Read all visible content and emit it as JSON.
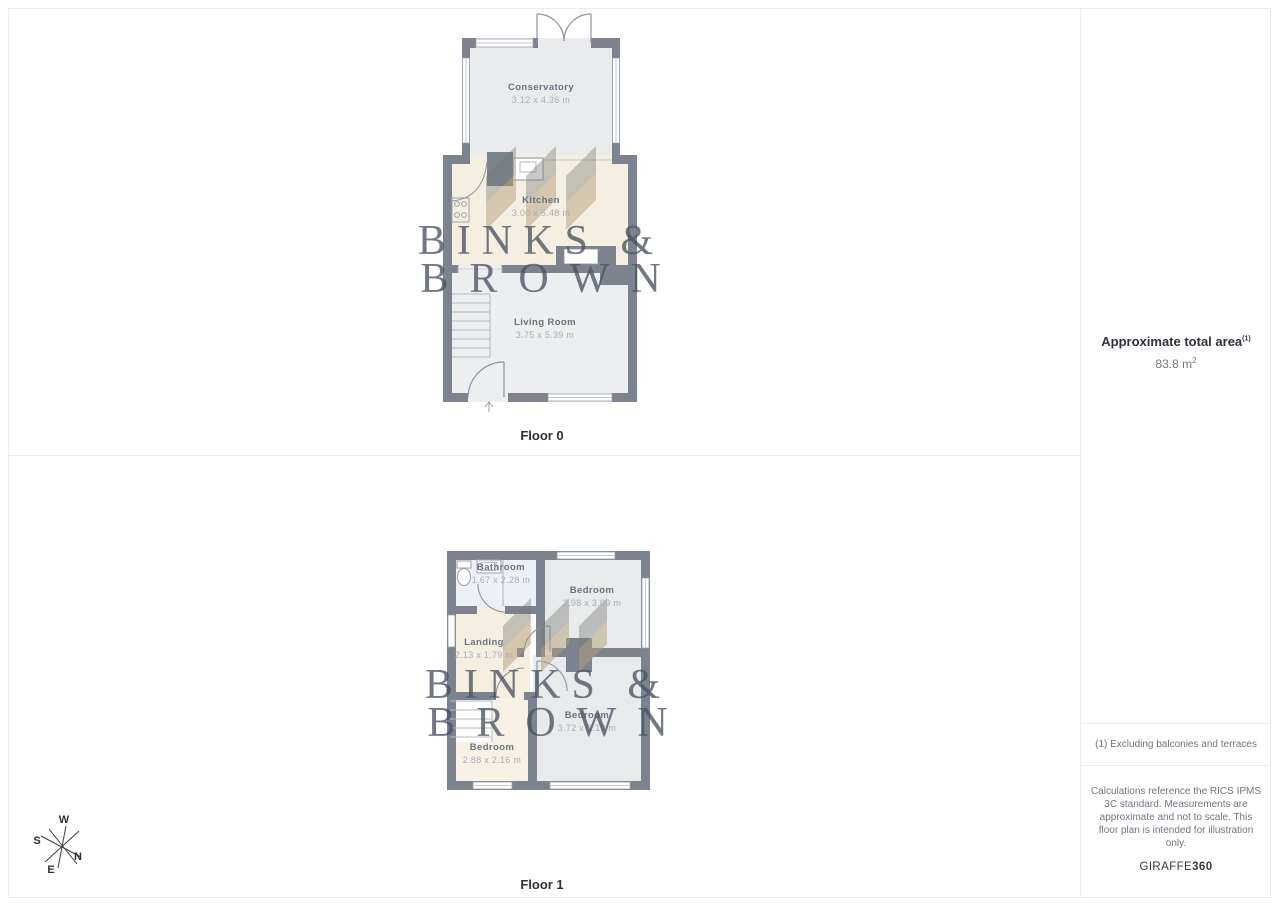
{
  "floor0": {
    "label": "Floor 0",
    "rooms": [
      {
        "name": "Conservatory",
        "dims": "3.12 x 4.36 m"
      },
      {
        "name": "Kitchen",
        "dims": "3.00 x 5.48 m"
      },
      {
        "name": "Living Room",
        "dims": "3.75 x 5.39 m"
      }
    ]
  },
  "floor1": {
    "label": "Floor 1",
    "rooms": [
      {
        "name": "Bathroom",
        "dims": "1.67 x 2.28 m"
      },
      {
        "name": "Bedroom",
        "dims": "2.98 x 3.09 m"
      },
      {
        "name": "Landing",
        "dims": "2.13 x 1.79 m"
      },
      {
        "name": "Bedroom",
        "dims": "2.88 x 2.16 m"
      },
      {
        "name": "Bedroom",
        "dims": "3.72 x 3.19 m"
      }
    ]
  },
  "watermark": {
    "line1": "BINKS &",
    "line2": "BROWN"
  },
  "sidebar": {
    "title": "Approximate total area",
    "title_sup": "(1)",
    "area_value": "83.8 m",
    "area_sup": "2",
    "footnote": "(1) Excluding balconies and terraces",
    "disclaimer": "Calculations reference the RICS IPMS 3C standard. Measurements are approximate and not to scale. This floor plan is intended for illustration only.",
    "brand": "GIRAFFE",
    "brand_suffix": "360"
  },
  "compass": {
    "n": "N",
    "s": "S",
    "e": "E",
    "w": "W"
  },
  "colors": {
    "wall": "#7c838e",
    "cream_floor": "#f5efe2",
    "gray_floor": "#eceef0",
    "bath_floor": "#edf1f7",
    "border": "#eaebec",
    "watermark_text": "#4a5260"
  }
}
